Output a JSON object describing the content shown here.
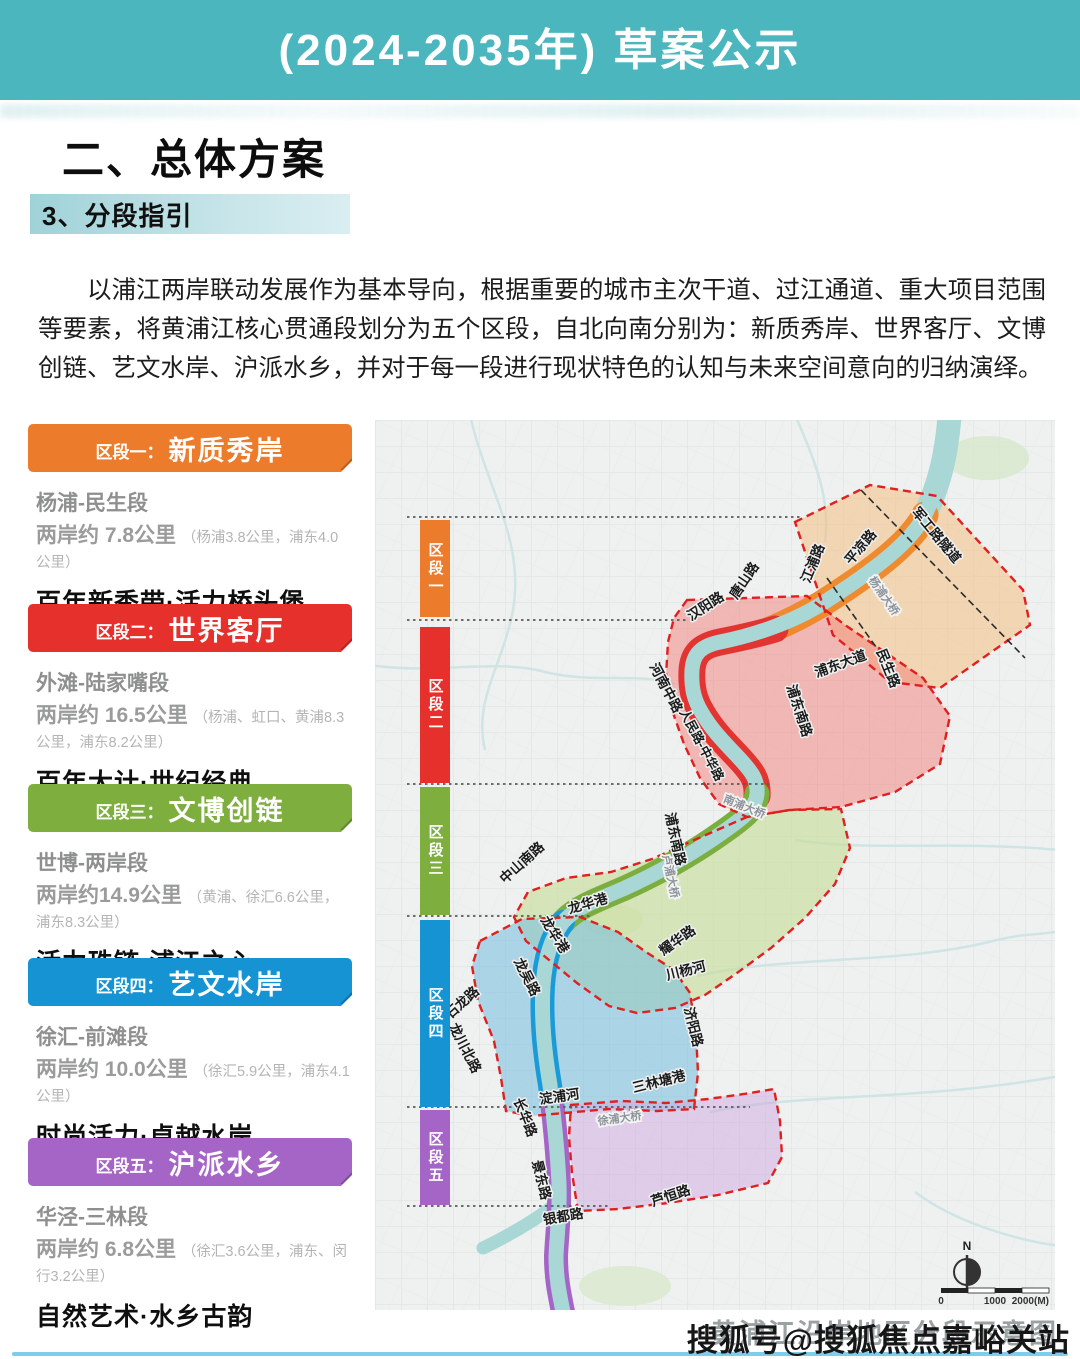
{
  "header": {
    "title": "(2024-2035年) 草案公示",
    "bg_color": "#4bb6bd"
  },
  "section": {
    "heading": "二、总体方案",
    "subheading": "3、分段指引"
  },
  "intro": "以浦江两岸联动发展作为基本导向，根据重要的城市主次干道、过江通道、重大项目范围等要素，将黄浦江核心贯通段划分为五个区段，自北向南分别为：新质秀岸、世界客厅、文博创链、艺文水岸、沪派水乡，并对于每一段进行现状特色的认知与未来空间意向的归纳演绎。",
  "segments": [
    {
      "badge": "区段一：",
      "name": "新质秀岸",
      "color": "#ec7c2c",
      "bar_label": "区段一",
      "range": "杨浦-民生段",
      "length": "两岸约 7.8公里",
      "detail": "（杨浦3.8公里，浦东4.0公里）",
      "slogan": "百年新秀带·活力桥头堡"
    },
    {
      "badge": "区段二：",
      "name": "世界客厅",
      "color": "#e5302c",
      "bar_label": "区段二",
      "range": "外滩-陆家嘴段",
      "length": "两岸约 16.5公里",
      "detail": "（杨浦、虹口、黄浦8.3公里，浦东8.2公里）",
      "slogan": "百年大计·世纪经典"
    },
    {
      "badge": "区段三：",
      "name": "文博创链",
      "color": "#7dae3e",
      "bar_label": "区段三",
      "range": "世博-两岸段",
      "length": "两岸约14.9公里",
      "detail": "（黄浦、徐汇6.6公里，浦东8.3公里）",
      "slogan": "活力珠链·浦江之心"
    },
    {
      "badge": "区段四：",
      "name": "艺文水岸",
      "color": "#1593d3",
      "bar_label": "区段四",
      "range": "徐汇-前滩段",
      "length": "两岸约 10.0公里",
      "detail": "（徐汇5.9公里，浦东4.1公里）",
      "slogan": "时尚活力·卓越水岸"
    },
    {
      "badge": "区段五：",
      "name": "沪派水乡",
      "color": "#a565c6",
      "bar_label": "区段五",
      "range": "华泾-三林段",
      "length": "两岸约 6.8公里",
      "detail": "（徐汇3.6公里，浦东、闵行3.2公里）",
      "slogan": "自然艺术·水乡古韵"
    }
  ],
  "map": {
    "labels": [
      "军工路隧道",
      "平凉路",
      "江浦路",
      "唐山路",
      "汉阳路",
      "浦东大道",
      "民生路",
      "河南中路",
      "人民路-中华路",
      "浦东南路",
      "浦东南路",
      "中山南路",
      "龙华港",
      "龙华港",
      "龙吴路",
      "石龙路",
      "龙川北路",
      "耀华路",
      "川杨河",
      "济阳路",
      "三林塘港",
      "淀浦河",
      "长华路",
      "景东路",
      "银都路",
      "芦恒路"
    ],
    "bridges": [
      "杨浦大桥",
      "南浦大桥",
      "卢浦大桥",
      "徐浦大桥"
    ],
    "compass_n": "N",
    "scale_ticks": [
      "0",
      "1000",
      "2000(M)"
    ],
    "caption": "黄浦江沿岸地区分段示意图"
  },
  "watermark": "搜狐号@搜狐焦点嘉峪关站"
}
